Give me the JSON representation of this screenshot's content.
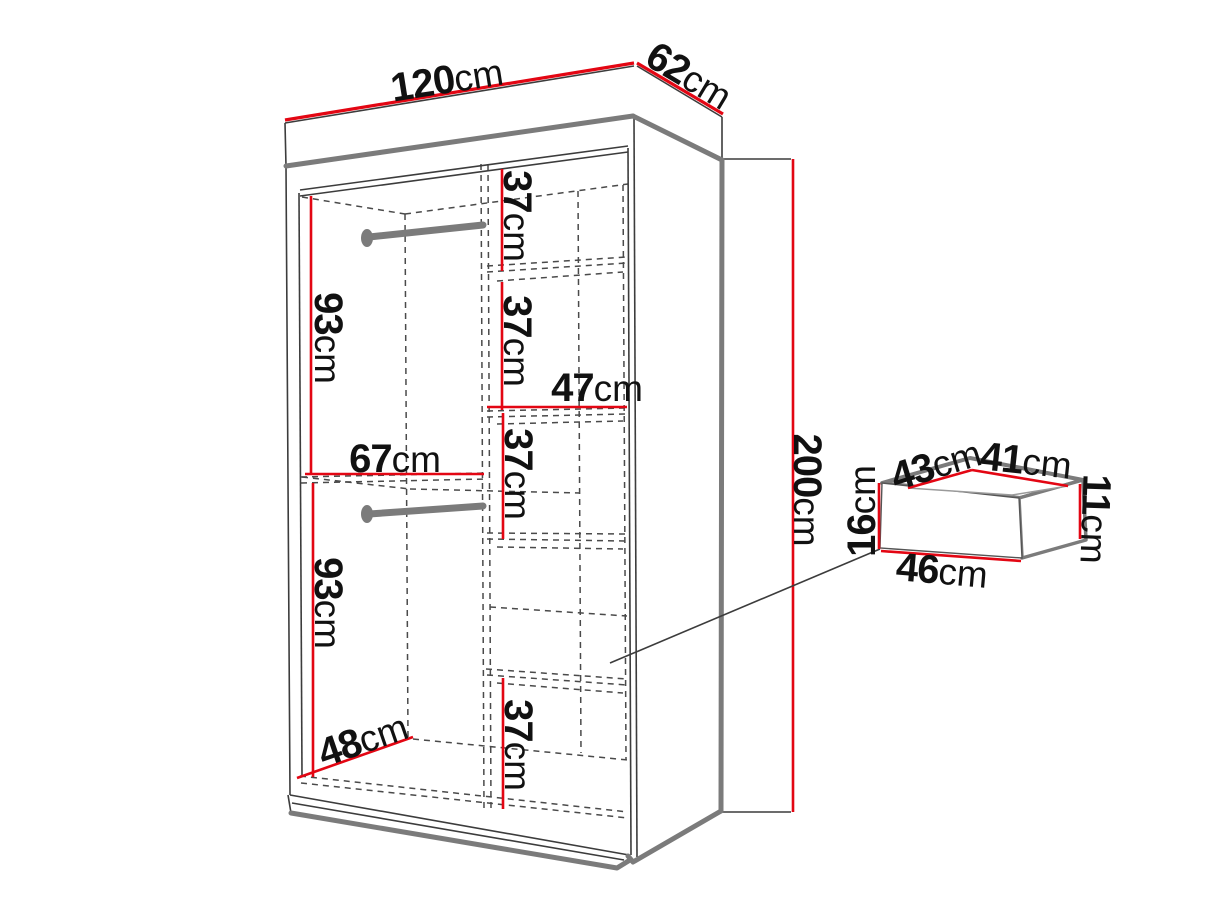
{
  "title": "Wardrobe technical dimensions diagram",
  "unit": "cm",
  "colors": {
    "dimension_red": "#e30613",
    "structure_gray": "#7b7b7b",
    "outline": "#3c3c3c",
    "text": "#111111",
    "background": "#ffffff"
  },
  "dims": {
    "total_width": {
      "value": "120",
      "unit": "cm"
    },
    "total_depth": {
      "value": "62",
      "unit": "cm"
    },
    "total_height": {
      "value": "200",
      "unit": "cm"
    },
    "hanging_upper": {
      "value": "93",
      "unit": "cm"
    },
    "hanging_lower": {
      "value": "93",
      "unit": "cm"
    },
    "shelf_gap_1": {
      "value": "37",
      "unit": "cm"
    },
    "shelf_gap_2": {
      "value": "37",
      "unit": "cm"
    },
    "shelf_gap_3": {
      "value": "37",
      "unit": "cm"
    },
    "shelf_gap_4": {
      "value": "37",
      "unit": "cm"
    },
    "shelf_width": {
      "value": "47",
      "unit": "cm"
    },
    "left_section_width": {
      "value": "67",
      "unit": "cm"
    },
    "interior_depth": {
      "value": "48",
      "unit": "cm"
    },
    "drawer_inner_depth": {
      "value": "43",
      "unit": "cm"
    },
    "drawer_inner_width": {
      "value": "41",
      "unit": "cm"
    },
    "drawer_front_height": {
      "value": "16",
      "unit": "cm"
    },
    "drawer_inner_height": {
      "value": "11",
      "unit": "cm"
    },
    "drawer_front_width": {
      "value": "46",
      "unit": "cm"
    }
  }
}
